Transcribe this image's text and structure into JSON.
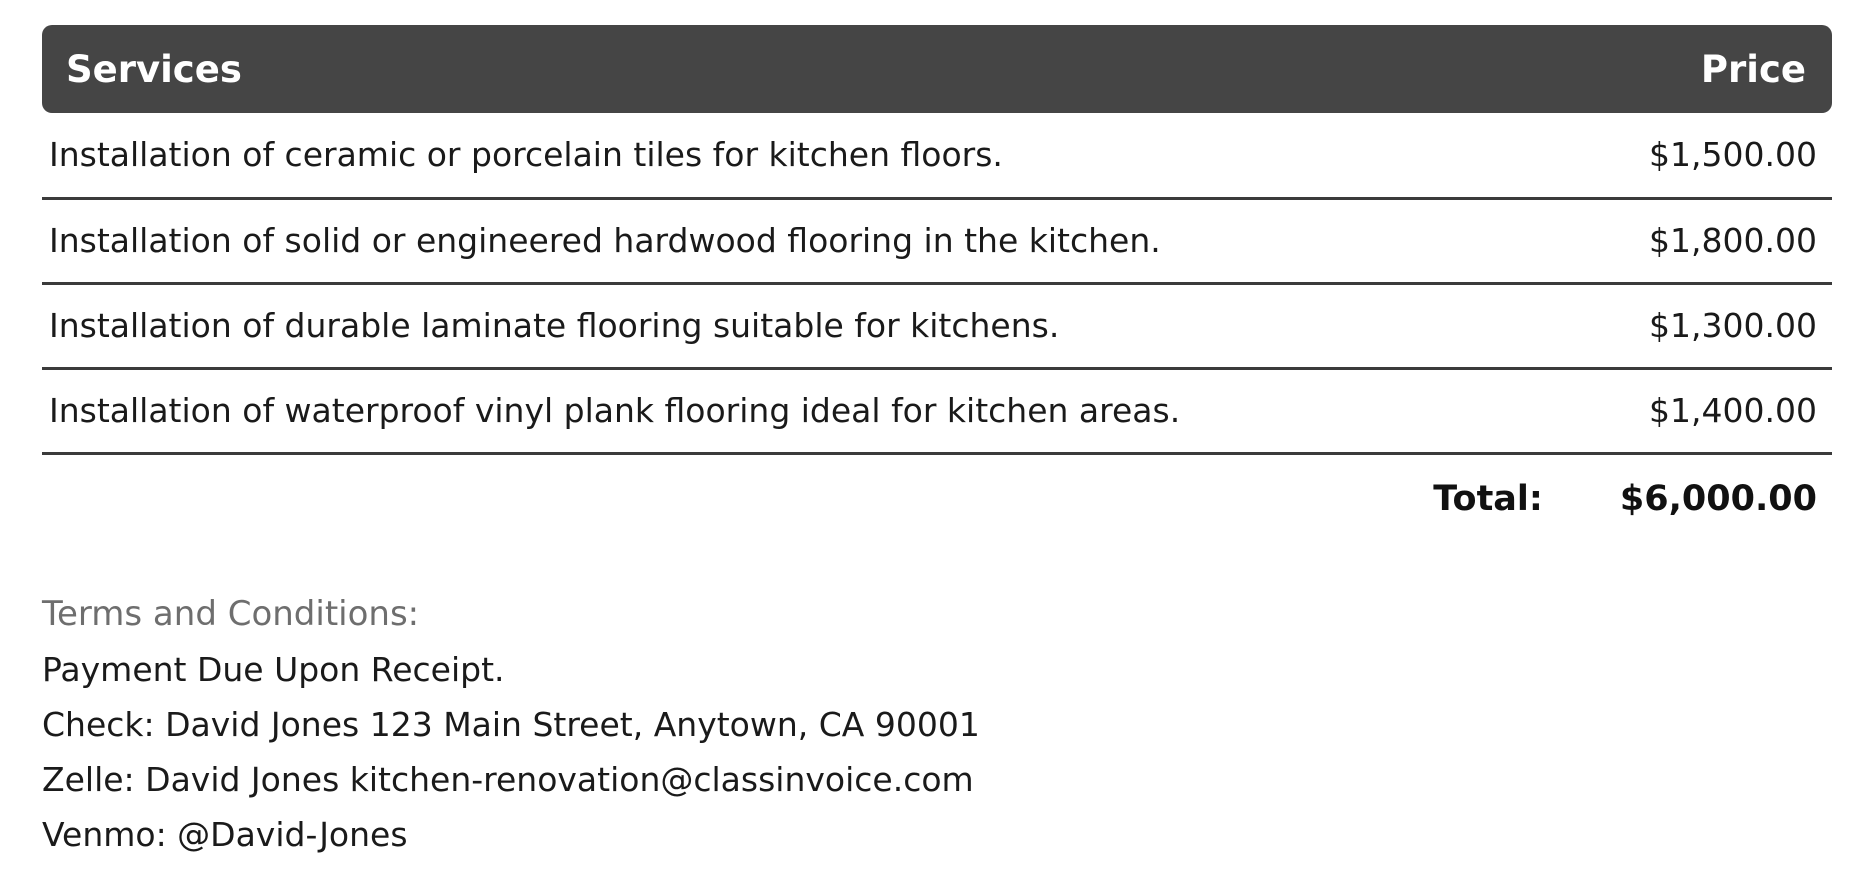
{
  "table": {
    "header": {
      "services": "Services",
      "price": "Price"
    },
    "rows": [
      {
        "service": "Installation of ceramic or porcelain tiles for kitchen floors.",
        "price": "$1,500.00"
      },
      {
        "service": "Installation of solid or engineered hardwood flooring in the kitchen.",
        "price": "$1,800.00"
      },
      {
        "service": "Installation of durable laminate flooring suitable for kitchens.",
        "price": "$1,300.00"
      },
      {
        "service": "Installation of waterproof vinyl plank flooring ideal for kitchen areas.",
        "price": "$1,400.00"
      }
    ],
    "total": {
      "label": "Total:",
      "value": "$6,000.00"
    }
  },
  "terms": {
    "title": "Terms and Conditions:",
    "lines": [
      "Payment Due Upon Receipt.",
      "Check: David Jones 123 Main Street, Anytown, CA 90001",
      "Zelle: David Jones kitchen-renovation@classinvoice.com",
      "Venmo: @David-Jones"
    ]
  },
  "colors": {
    "header_bg": "#454545",
    "header_text": "#ffffff",
    "body_text": "#1a1a1a",
    "divider": "#3b3b3b",
    "terms_title": "#6e6e6e"
  }
}
